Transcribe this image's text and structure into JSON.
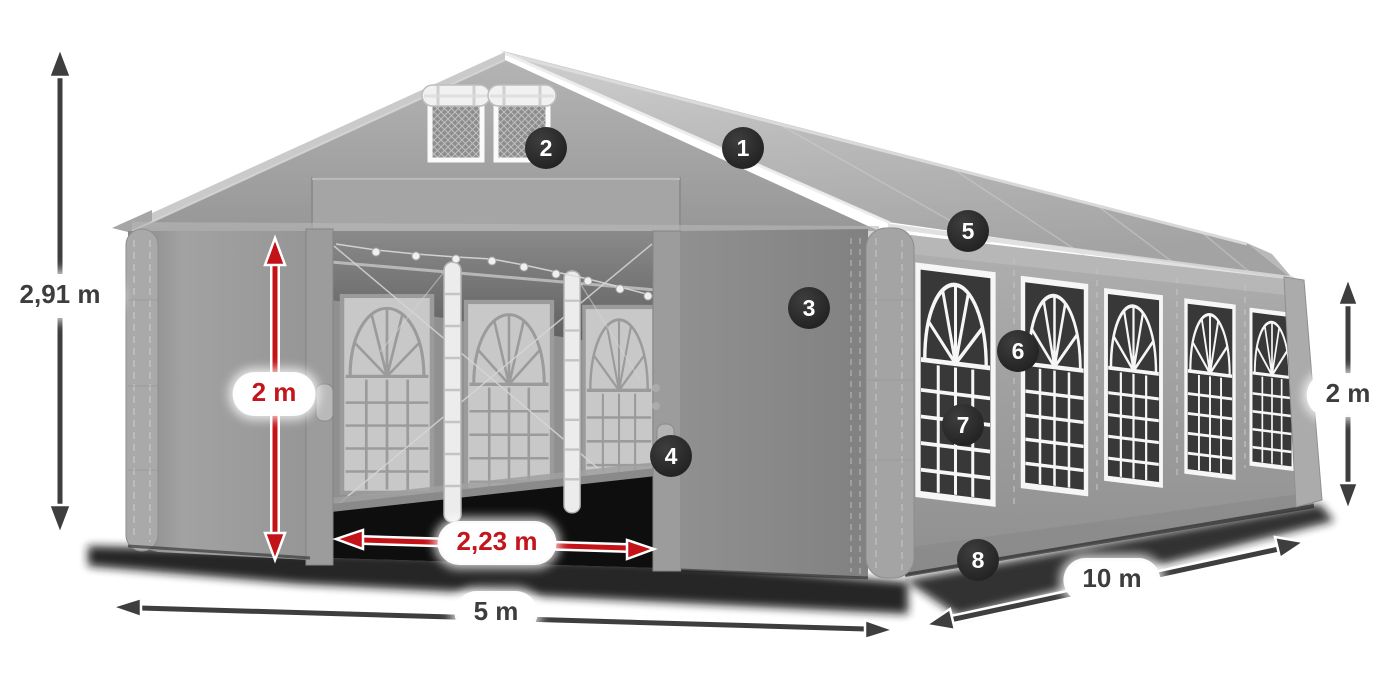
{
  "illustration": {
    "subject": "party tent 5 x 10 m with dimension arrows and numbered feature callouts",
    "colors": {
      "tent_light": "#c6c6c6",
      "tent_mid": "#9e9e9e",
      "tent_dark": "#858585",
      "window_dark": "#383838",
      "frame_white": "#f6f6f6",
      "arrow_dark": "#3e3e3e",
      "arrow_red": "#c31318",
      "badge_bg": "#2b2b2b",
      "label_text_dark": "#3d3d3d",
      "label_text_red": "#c3151b"
    }
  },
  "measurements": {
    "total_height": "2,91 m",
    "inner_height": "2 m",
    "entrance_width": "2,23 m",
    "front_width": "5 m",
    "side_length": "10 m",
    "side_wall_height": "2 m"
  },
  "callouts": [
    {
      "number": "1"
    },
    {
      "number": "2"
    },
    {
      "number": "3"
    },
    {
      "number": "4"
    },
    {
      "number": "5"
    },
    {
      "number": "6"
    },
    {
      "number": "7"
    },
    {
      "number": "8"
    }
  ]
}
